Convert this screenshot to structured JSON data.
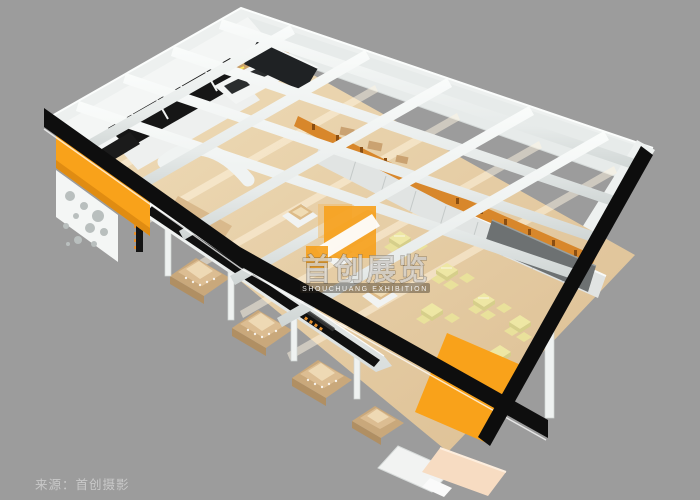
{
  "watermark": {
    "title": "首创展览",
    "subtitle": "SHOUCHUANG EXHIBITION",
    "logo": "orange-s-logo"
  },
  "caption": {
    "source": "来源：首创摄影"
  },
  "palette": {
    "background": "#9c9c9c",
    "accent_orange": "#f9a21a",
    "fascia_black": "#0e0e0e",
    "wall_white": "#eef1f0",
    "floor_wood": "#e6cda6",
    "table_yellow": "#eee7a4",
    "counter_wood": "#d8b88a",
    "panel_gray": "#6d7172"
  }
}
